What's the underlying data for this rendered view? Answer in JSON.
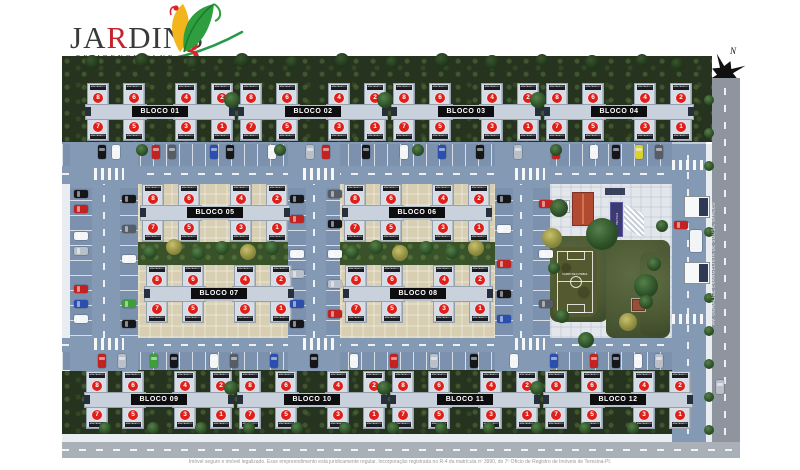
{
  "logo": {
    "title_pre": "JA",
    "title_accent": "R",
    "title_post": "DINS",
    "subtitle": "RESIDENCE CLUB",
    "number": "3"
  },
  "compass": {
    "label": "N"
  },
  "avenue": {
    "label": "AV. DORALICE EVANGELISTA DE SOUSA, DIRCEU"
  },
  "disclaimer": "Imóvel seguro e imóvel legalizado. Esse empreendimento está juridicamente regular. Incorporação registrada no R-4 da matrícula nº 3990, do 7º Ofício de Registro de Imóveis de Teresina-PI.",
  "amenities": {
    "field_label": "CAMPO DE FUTEBOL",
    "pool_label": "PISCINA"
  },
  "block_unit_chip": "APARTAMENTO",
  "unit_numbers_top": [
    8,
    6,
    4,
    2
  ],
  "unit_numbers_bottom": [
    7,
    5,
    3,
    1
  ],
  "blocks": [
    {
      "label": "BLOCO 01",
      "x": 23,
      "y": 27
    },
    {
      "label": "BLOCO 02",
      "x": 176,
      "y": 27
    },
    {
      "label": "BLOCO 03",
      "x": 329,
      "y": 27
    },
    {
      "label": "BLOCO 04",
      "x": 482,
      "y": 27
    },
    {
      "label": "BLOCO 05",
      "x": 78,
      "y": 128
    },
    {
      "label": "BLOCO 06",
      "x": 280,
      "y": 128
    },
    {
      "label": "BLOCO 07",
      "x": 82,
      "y": 209
    },
    {
      "label": "BLOCO 08",
      "x": 281,
      "y": 209
    },
    {
      "label": "BLOCO 09",
      "x": 22,
      "y": 315
    },
    {
      "label": "BLOCO 10",
      "x": 175,
      "y": 315
    },
    {
      "label": "BLOCO 11",
      "x": 328,
      "y": 315
    },
    {
      "label": "BLOCO 12",
      "x": 481,
      "y": 315
    }
  ],
  "colors": {
    "accent_red": "#d6252b",
    "logo_green": "#27994a",
    "building": "#d6dde6",
    "unit_badge": "#df1f1a",
    "road": "#8399b4",
    "cars": {
      "k": "#14161a",
      "w": "#f3f5f7",
      "r": "#c32320",
      "b": "#2b4fae",
      "s": "#b9c0c9",
      "g": "#565d66",
      "y": "#d9d234",
      "n": "#3f9e3c"
    }
  },
  "cars": [
    [
      36,
      89,
      "v",
      "k"
    ],
    [
      50,
      89,
      "v",
      "w"
    ],
    [
      90,
      89,
      "v",
      "r"
    ],
    [
      106,
      89,
      "v",
      "g"
    ],
    [
      148,
      89,
      "v",
      "b"
    ],
    [
      164,
      89,
      "v",
      "k"
    ],
    [
      206,
      89,
      "v",
      "w"
    ],
    [
      244,
      89,
      "v",
      "s"
    ],
    [
      260,
      89,
      "v",
      "r"
    ],
    [
      300,
      89,
      "v",
      "k"
    ],
    [
      338,
      89,
      "v",
      "w"
    ],
    [
      376,
      89,
      "v",
      "b"
    ],
    [
      414,
      89,
      "v",
      "k"
    ],
    [
      452,
      89,
      "v",
      "s"
    ],
    [
      490,
      89,
      "v",
      "r"
    ],
    [
      528,
      89,
      "v",
      "w"
    ],
    [
      550,
      89,
      "v",
      "k"
    ],
    [
      573,
      89,
      "v",
      "y"
    ],
    [
      593,
      89,
      "v",
      "g"
    ],
    [
      36,
      298,
      "v",
      "r"
    ],
    [
      56,
      298,
      "v",
      "s"
    ],
    [
      88,
      298,
      "v",
      "n"
    ],
    [
      108,
      298,
      "v",
      "k"
    ],
    [
      148,
      298,
      "v",
      "w"
    ],
    [
      168,
      298,
      "v",
      "g"
    ],
    [
      208,
      298,
      "v",
      "b"
    ],
    [
      248,
      298,
      "v",
      "k"
    ],
    [
      288,
      298,
      "v",
      "w"
    ],
    [
      328,
      298,
      "v",
      "r"
    ],
    [
      368,
      298,
      "v",
      "s"
    ],
    [
      408,
      298,
      "v",
      "k"
    ],
    [
      448,
      298,
      "v",
      "w"
    ],
    [
      488,
      298,
      "v",
      "b"
    ],
    [
      528,
      298,
      "v",
      "r"
    ],
    [
      550,
      298,
      "v",
      "k"
    ],
    [
      572,
      298,
      "v",
      "w"
    ],
    [
      593,
      298,
      "v",
      "s"
    ],
    [
      12,
      134,
      "h",
      "k"
    ],
    [
      12,
      149,
      "h",
      "r"
    ],
    [
      12,
      176,
      "h",
      "w"
    ],
    [
      12,
      191,
      "h",
      "s"
    ],
    [
      12,
      229,
      "h",
      "r"
    ],
    [
      12,
      244,
      "h",
      "b"
    ],
    [
      12,
      259,
      "h",
      "w"
    ],
    [
      60,
      139,
      "h",
      "k"
    ],
    [
      60,
      169,
      "h",
      "g"
    ],
    [
      60,
      199,
      "h",
      "w"
    ],
    [
      60,
      244,
      "h",
      "n"
    ],
    [
      60,
      264,
      "h",
      "k"
    ],
    [
      228,
      139,
      "h",
      "k"
    ],
    [
      228,
      159,
      "h",
      "r"
    ],
    [
      228,
      194,
      "h",
      "w"
    ],
    [
      228,
      214,
      "h",
      "s"
    ],
    [
      228,
      244,
      "h",
      "b"
    ],
    [
      228,
      264,
      "h",
      "k"
    ],
    [
      266,
      134,
      "h",
      "g"
    ],
    [
      266,
      164,
      "h",
      "k"
    ],
    [
      266,
      194,
      "h",
      "w"
    ],
    [
      266,
      224,
      "h",
      "s"
    ],
    [
      266,
      254,
      "h",
      "r"
    ],
    [
      435,
      139,
      "h",
      "k"
    ],
    [
      435,
      169,
      "h",
      "w"
    ],
    [
      435,
      204,
      "h",
      "r"
    ],
    [
      435,
      234,
      "h",
      "k"
    ],
    [
      435,
      259,
      "h",
      "b"
    ],
    [
      477,
      144,
      "h",
      "r"
    ],
    [
      477,
      194,
      "h",
      "w"
    ],
    [
      477,
      244,
      "h",
      "g"
    ],
    [
      612,
      165,
      "h",
      "r"
    ],
    [
      654,
      324,
      "v",
      "s"
    ]
  ],
  "trees": [
    [
      30,
      6,
      7,
      "d"
    ],
    [
      80,
      4,
      7,
      "d"
    ],
    [
      130,
      7,
      6,
      "d"
    ],
    [
      180,
      4,
      7,
      "d"
    ],
    [
      230,
      6,
      6,
      "d"
    ],
    [
      280,
      4,
      7,
      "d"
    ],
    [
      330,
      6,
      6,
      "d"
    ],
    [
      380,
      4,
      7,
      "d"
    ],
    [
      430,
      6,
      7,
      "d"
    ],
    [
      480,
      4,
      6,
      "d"
    ],
    [
      530,
      6,
      7,
      "d"
    ],
    [
      580,
      4,
      6,
      "d"
    ],
    [
      615,
      8,
      6,
      "d"
    ],
    [
      170,
      44,
      8,
      "g"
    ],
    [
      323,
      44,
      8,
      "g"
    ],
    [
      476,
      44,
      8,
      "g"
    ],
    [
      80,
      94,
      6,
      "g"
    ],
    [
      218,
      94,
      6,
      "g"
    ],
    [
      356,
      94,
      6,
      "g"
    ],
    [
      494,
      94,
      6,
      "g"
    ],
    [
      88,
      196,
      7,
      "g"
    ],
    [
      112,
      191,
      8,
      "y"
    ],
    [
      136,
      197,
      7,
      "g"
    ],
    [
      160,
      192,
      7,
      "g"
    ],
    [
      186,
      196,
      8,
      "y"
    ],
    [
      210,
      192,
      7,
      "g"
    ],
    [
      290,
      196,
      7,
      "g"
    ],
    [
      314,
      191,
      7,
      "g"
    ],
    [
      338,
      197,
      8,
      "y"
    ],
    [
      364,
      192,
      7,
      "g"
    ],
    [
      390,
      196,
      7,
      "g"
    ],
    [
      414,
      192,
      8,
      "y"
    ],
    [
      540,
      178,
      16,
      "g"
    ],
    [
      497,
      152,
      9,
      "g"
    ],
    [
      490,
      182,
      10,
      "y"
    ],
    [
      584,
      230,
      12,
      "g"
    ],
    [
      566,
      266,
      9,
      "y"
    ],
    [
      500,
      260,
      7,
      "g"
    ],
    [
      524,
      284,
      8,
      "g"
    ],
    [
      492,
      212,
      6,
      "g"
    ],
    [
      592,
      208,
      7,
      "g"
    ],
    [
      584,
      246,
      7,
      "g"
    ],
    [
      600,
      170,
      6,
      "g"
    ],
    [
      647,
      44,
      5,
      "g"
    ],
    [
      647,
      77,
      5,
      "g"
    ],
    [
      647,
      110,
      5,
      "g"
    ],
    [
      647,
      176,
      5,
      "g"
    ],
    [
      647,
      242,
      5,
      "g"
    ],
    [
      647,
      275,
      5,
      "g"
    ],
    [
      647,
      308,
      5,
      "g"
    ],
    [
      647,
      341,
      5,
      "g"
    ],
    [
      647,
      374,
      5,
      "g"
    ],
    [
      43,
      372,
      6,
      "g"
    ],
    [
      91,
      372,
      6,
      "g"
    ],
    [
      139,
      372,
      6,
      "g"
    ],
    [
      187,
      372,
      6,
      "g"
    ],
    [
      235,
      372,
      6,
      "g"
    ],
    [
      283,
      372,
      6,
      "g"
    ],
    [
      331,
      372,
      6,
      "g"
    ],
    [
      379,
      372,
      6,
      "g"
    ],
    [
      427,
      372,
      6,
      "g"
    ],
    [
      475,
      372,
      6,
      "g"
    ],
    [
      523,
      372,
      6,
      "g"
    ],
    [
      571,
      372,
      6,
      "g"
    ],
    [
      169,
      332,
      7,
      "g"
    ],
    [
      322,
      332,
      7,
      "g"
    ],
    [
      475,
      332,
      7,
      "g"
    ]
  ]
}
